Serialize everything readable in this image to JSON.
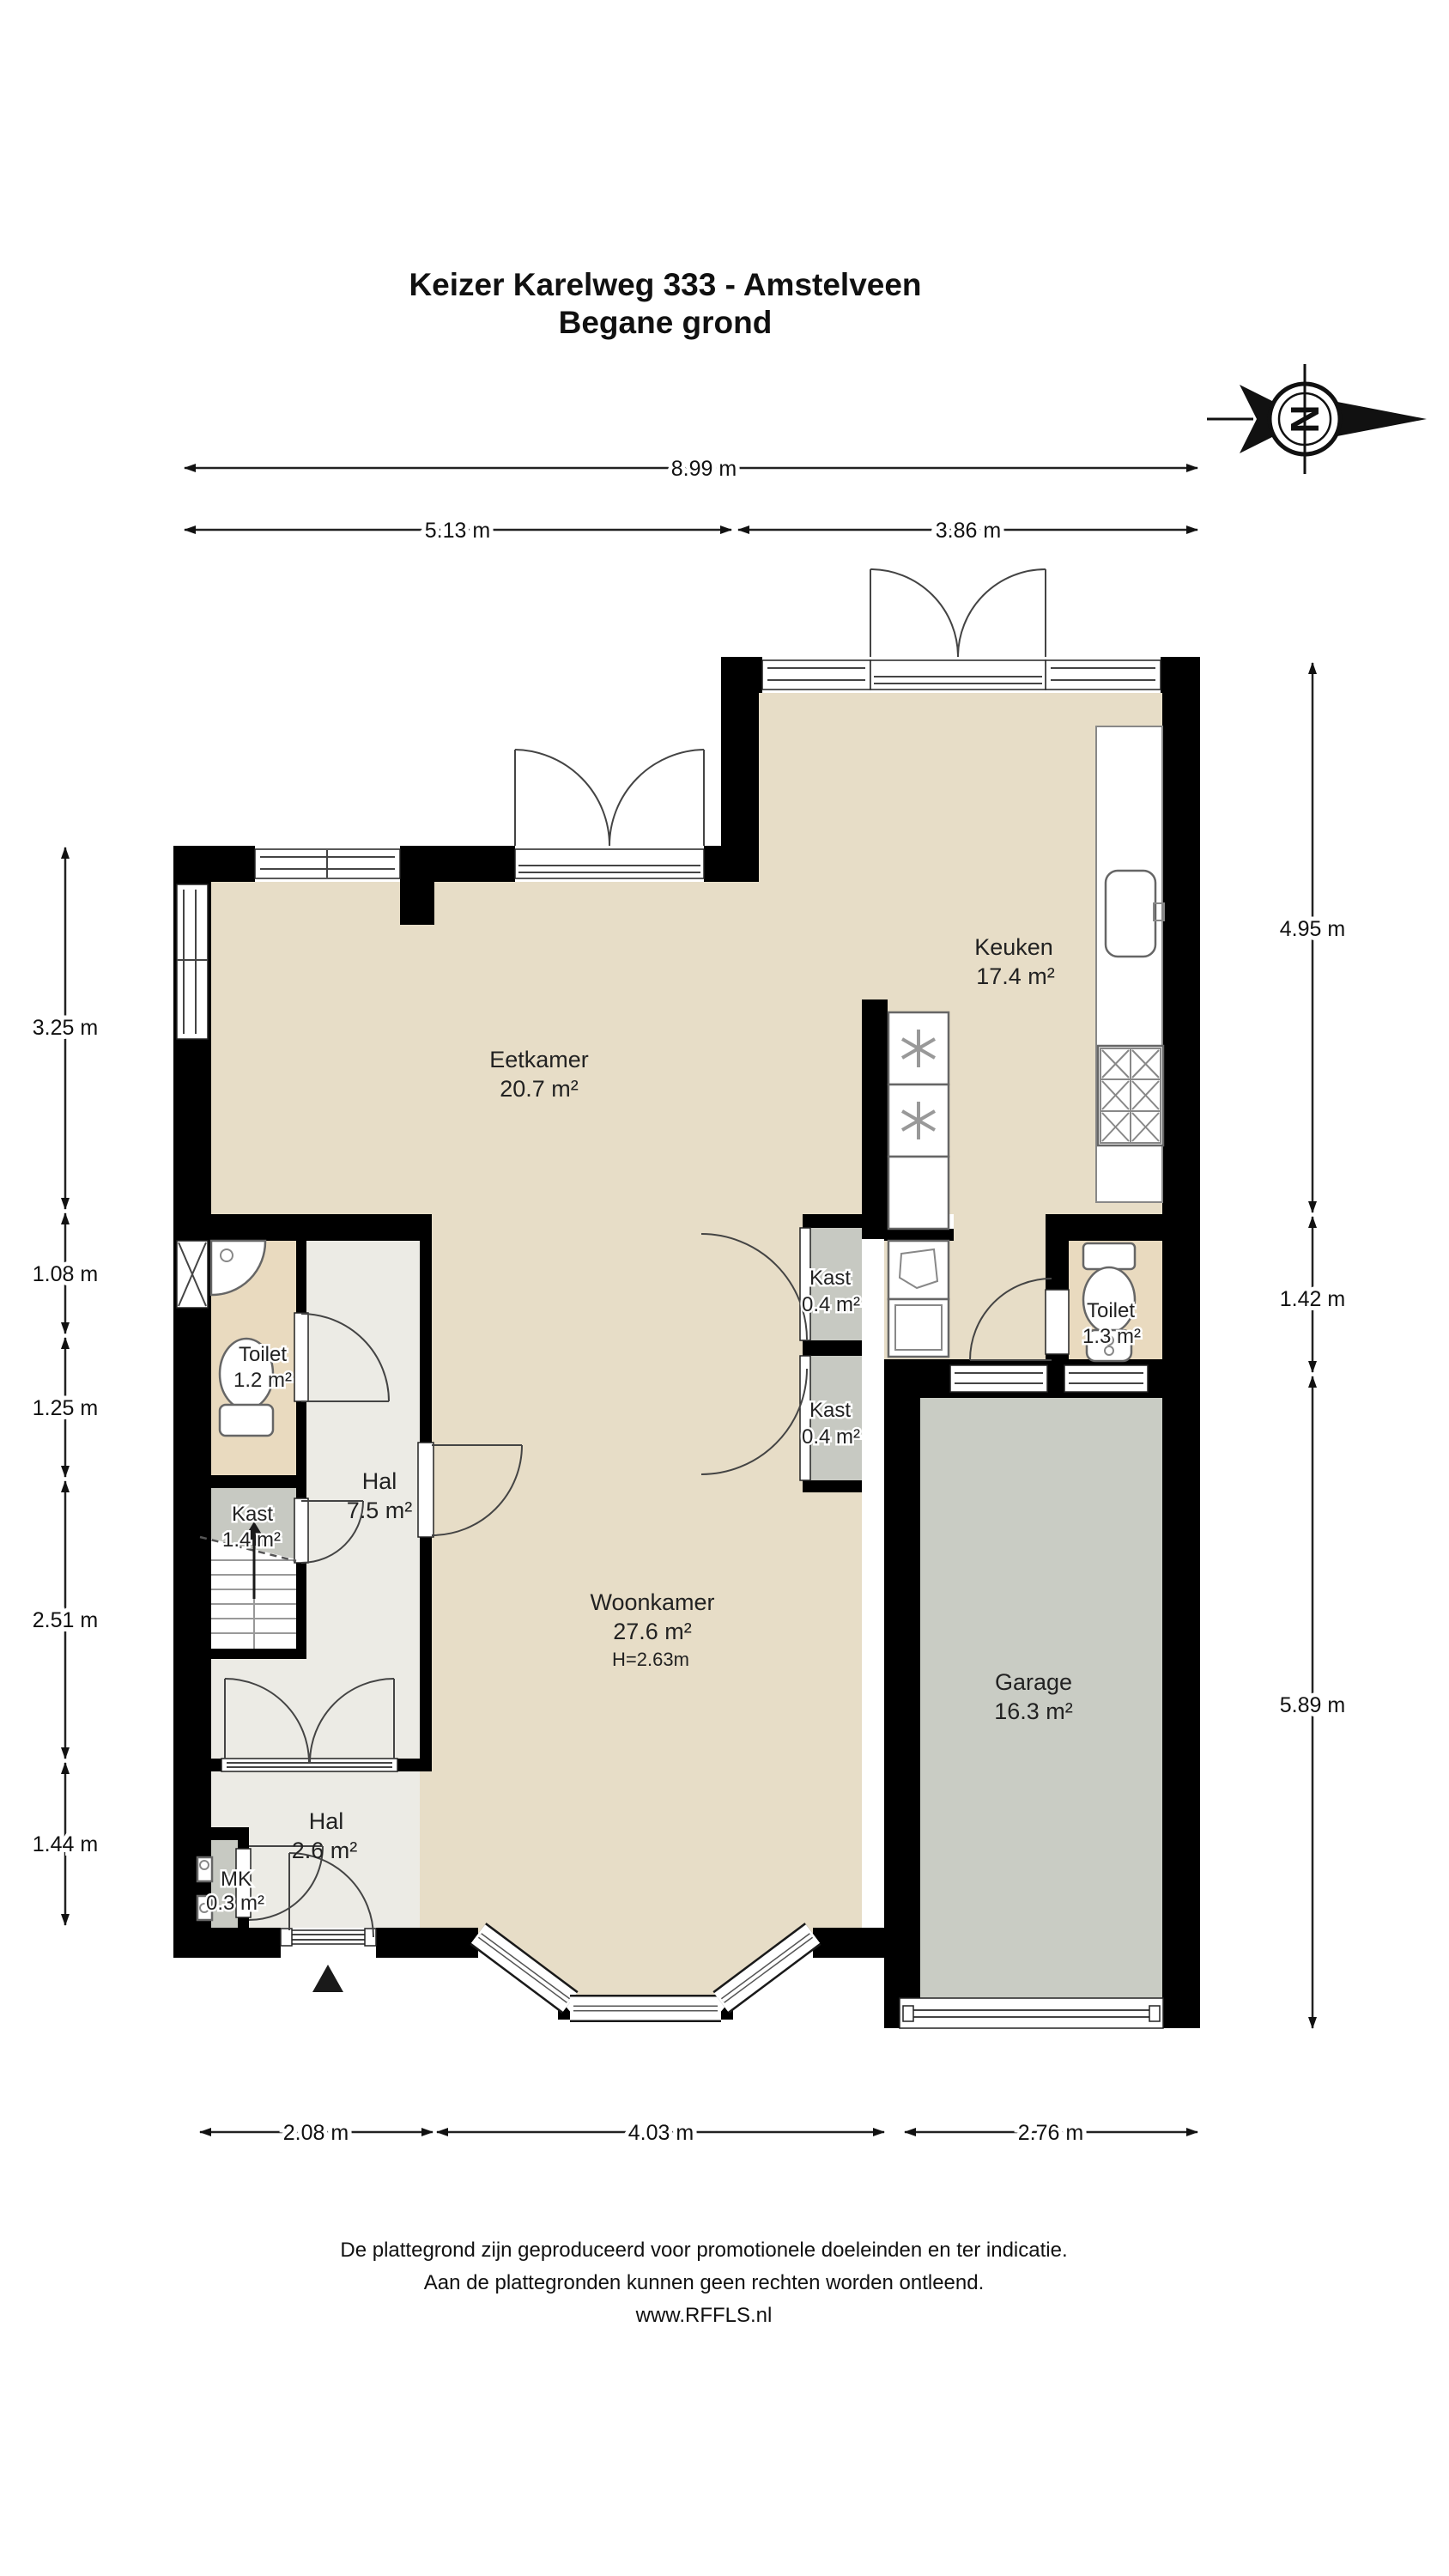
{
  "title": {
    "line1": "Keizer Karelweg 333 - Amstelveen",
    "line2": "Begane grond"
  },
  "compass": {
    "letter": "N"
  },
  "rooms": {
    "eetkamer": {
      "name": "Eetkamer",
      "area": "20.7 m²"
    },
    "keuken": {
      "name": "Keuken",
      "area": "17.4 m²"
    },
    "woonkamer": {
      "name": "Woonkamer",
      "area": "27.6 m²",
      "height": "H=2.63m"
    },
    "hal": {
      "name": "Hal",
      "area": "7.5 m²"
    },
    "toilet_links": {
      "name": "Toilet",
      "area": "1.2 m²"
    },
    "kast_hal": {
      "name": "Kast",
      "area": "1.4 m²"
    },
    "kast_boven": {
      "name": "Kast",
      "area": "0.4 m²"
    },
    "kast_onder": {
      "name": "Kast",
      "area": "0.4 m²"
    },
    "toilet_rechts": {
      "name": "Toilet",
      "area": "1.3 m²"
    },
    "garage": {
      "name": "Garage",
      "area": "16.3 m²"
    },
    "entree": {
      "name": "Hal",
      "area": "2.6 m²"
    },
    "meterkast": {
      "name": "MK",
      "area": "0.3 m²"
    }
  },
  "dimensions": {
    "top_total": "8.99 m",
    "top_left": "5.13 m",
    "top_right": "3.86 m",
    "left_1": "3.25 m",
    "left_2": "1.08 m",
    "left_3": "1.25 m",
    "left_4": "2.51 m",
    "left_5": "1.44 m",
    "right_1": "4.95 m",
    "right_2": "1.42 m",
    "right_3": "5.89 m",
    "bottom_1": "2.08 m",
    "bottom_2": "4.03 m",
    "bottom_3": "2.76 m"
  },
  "footer": {
    "line1": "De plattegrond zijn geproduceerd voor promotionele doeleinden en ter indicatie.",
    "line2": "Aan de plattegronden kunnen geen rechten worden ontleend.",
    "line3": "www.RFFLS.nl"
  },
  "colors": {
    "floor": "#e7ddc7",
    "hall": "#ecebe5",
    "closet": "#c7c9c2",
    "garage": "#c9ccc4",
    "toilet_floor": "#e9dabf",
    "wall": "#000000"
  }
}
